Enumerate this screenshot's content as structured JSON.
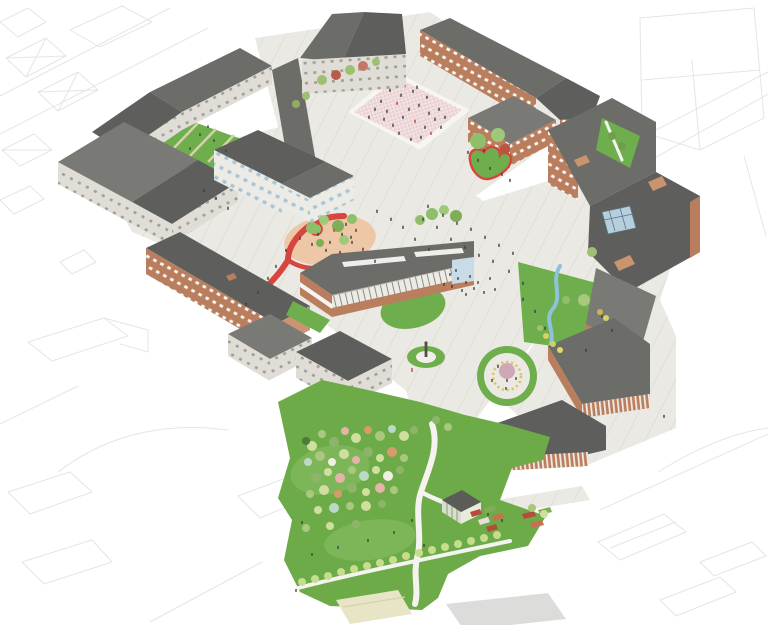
{
  "scene": {
    "kind": "axonometric-masterplan-illustration",
    "subject": "campus masterplan with brick and grey-roofed buildings, paved plazas, lawns, a red ribbon path, a circular pergola garden and a tree-filled park, surrounded by faint line-drawn context city blocks"
  },
  "palette": {
    "white": "#f6f5f1",
    "contextLine": "#e6e5e3",
    "ground": "#ebe9e4",
    "groundLine": "#dcd9d2",
    "roofDark": "#5e5f5c",
    "roofMid": "#6c6d69",
    "roofMid2": "#797a75",
    "roofLight": "#8b8c86",
    "wallLight": "#e0ddd6",
    "wallWhite": "#edebe5",
    "brick": "#b97e5d",
    "brickLight": "#c9946f",
    "windowBlue": "#a9c6d9",
    "glass": "#c8dbe6",
    "skylight": "#b5cfdd",
    "lawn": "#6fae4c",
    "lawnLight": "#8cc167",
    "parkGreen": "#6cab48",
    "pathBeige": "#d8cfae",
    "pinkPlaza": "#f4e3e3",
    "pinkChecker": "#e9d0d2",
    "ovalPink": "#eec7a7",
    "red": "#d6453f",
    "stream": "#8fc2d8",
    "pergolaYellow": "#d8c469",
    "beigeLot": "#e8e4c6",
    "grayLot": "#dcdcda",
    "people": "#3e3e3e",
    "statue": "#564e44",
    "treeTrunk": "#6b5840",
    "greenhouseWall": "#d8decf",
    "greenhouseRoof": "#5b5b58"
  },
  "features": [
    {
      "name": "context-city-outlines",
      "palette": "contextLine"
    },
    {
      "name": "paved-campus-ground",
      "palette": "ground"
    },
    {
      "name": "courtyard-lawn",
      "palette": "lawn"
    },
    {
      "name": "checkered-plaza",
      "palette": "pinkPlaza"
    },
    {
      "name": "red-ribbon-path",
      "palette": "red"
    },
    {
      "name": "oval-playground",
      "palette": "ovalPink"
    },
    {
      "name": "heart-planter",
      "palette": "lawn"
    },
    {
      "name": "stream",
      "palette": "stream"
    },
    {
      "name": "circular-pergola-garden",
      "palette": "pergolaYellow"
    },
    {
      "name": "statue-mound",
      "palette": "lawn"
    },
    {
      "name": "community-park",
      "palette": "parkGreen"
    },
    {
      "name": "greenhouse",
      "palette": "greenhouseWall"
    },
    {
      "name": "allotment-beds",
      "palette": "red"
    }
  ],
  "scatters": [
    {
      "target": "park-trees",
      "name": "park-tree",
      "kind": "circle",
      "color": "#a9c87e",
      "size": 4,
      "points": [
        [
          312,
          446,
          5,
          "#cfe09e"
        ],
        [
          322,
          434,
          4,
          "#a9c87e"
        ],
        [
          334,
          442,
          5,
          "#8db56a"
        ],
        [
          345,
          431,
          4,
          "#e6b3a8"
        ],
        [
          356,
          438,
          5,
          "#cfe09e"
        ],
        [
          368,
          430,
          4,
          "#d79a69"
        ],
        [
          380,
          436,
          5,
          "#a9c87e"
        ],
        [
          392,
          429,
          4,
          "#bcd8c6"
        ],
        [
          404,
          436,
          5,
          "#cfe09e"
        ],
        [
          414,
          430,
          4,
          "#8db56a"
        ],
        [
          306,
          441,
          4,
          "#50793b"
        ],
        [
          308,
          462,
          4,
          "#bcd8c6"
        ],
        [
          320,
          456,
          5,
          "#a9c87e"
        ],
        [
          332,
          462,
          4,
          "#f0efe4"
        ],
        [
          344,
          454,
          5,
          "#cfe09e"
        ],
        [
          356,
          460,
          4,
          "#e6b3a8"
        ],
        [
          368,
          452,
          5,
          "#8db56a"
        ],
        [
          380,
          458,
          4,
          "#cfe09e"
        ],
        [
          392,
          452,
          5,
          "#d79a69"
        ],
        [
          404,
          458,
          4,
          "#a9c87e"
        ],
        [
          316,
          478,
          5,
          "#8db56a"
        ],
        [
          328,
          472,
          4,
          "#cfe09e"
        ],
        [
          340,
          478,
          5,
          "#e6b3a8"
        ],
        [
          352,
          470,
          4,
          "#a9c87e"
        ],
        [
          364,
          476,
          5,
          "#bcd8c6"
        ],
        [
          376,
          470,
          4,
          "#cfe09e"
        ],
        [
          388,
          476,
          5,
          "#f0efe4"
        ],
        [
          400,
          470,
          4,
          "#8db56a"
        ],
        [
          310,
          494,
          4,
          "#a9c87e"
        ],
        [
          324,
          490,
          5,
          "#cfe09e"
        ],
        [
          338,
          494,
          4,
          "#d79a69"
        ],
        [
          352,
          488,
          5,
          "#8db56a"
        ],
        [
          366,
          492,
          4,
          "#cfe09e"
        ],
        [
          380,
          488,
          5,
          "#e6b3a8"
        ],
        [
          394,
          490,
          4,
          "#a9c87e"
        ],
        [
          318,
          510,
          4,
          "#cfe09e"
        ],
        [
          334,
          508,
          5,
          "#bcd8c6"
        ],
        [
          350,
          506,
          4,
          "#a9c87e"
        ],
        [
          366,
          506,
          5,
          "#cfe09e"
        ],
        [
          382,
          504,
          4,
          "#8db56a"
        ],
        [
          306,
          528,
          4,
          "#a9c87e"
        ],
        [
          330,
          526,
          4,
          "#cfe09e"
        ],
        [
          356,
          524,
          4,
          "#8db56a"
        ],
        [
          436,
          420,
          4,
          "#8db56a"
        ],
        [
          448,
          427,
          4,
          "#a9c87e"
        ],
        [
          532,
          508,
          4,
          "#a9c87e"
        ],
        [
          544,
          514,
          4,
          "#cfe09e"
        ]
      ]
    },
    {
      "target": "row-trees",
      "name": "path-row-tree",
      "kind": "circle",
      "color": "#c6dc8e",
      "size": 4,
      "points": [
        [
          302,
          582
        ],
        [
          315,
          579
        ],
        [
          328,
          576
        ],
        [
          341,
          572
        ],
        [
          354,
          569
        ],
        [
          367,
          566
        ],
        [
          380,
          563
        ],
        [
          393,
          560
        ],
        [
          406,
          556
        ],
        [
          419,
          553
        ],
        [
          432,
          550
        ],
        [
          445,
          547
        ],
        [
          458,
          544
        ],
        [
          471,
          541
        ],
        [
          484,
          538
        ],
        [
          497,
          535
        ]
      ]
    },
    {
      "target": "north-row-trees",
      "name": "street-tree",
      "kind": "circle",
      "color": "#9fbf72",
      "size": 4,
      "points": [
        [
          322,
          80,
          5,
          "#9fbf72"
        ],
        [
          336,
          75,
          5,
          "#b85c4a"
        ],
        [
          350,
          70,
          5,
          "#9fbf72"
        ],
        [
          363,
          66,
          5,
          "#c4766a"
        ],
        [
          376,
          62,
          4,
          "#9fbf72"
        ],
        [
          306,
          96,
          4,
          "#9fbf72"
        ],
        [
          296,
          104,
          4,
          "#8fae62"
        ]
      ]
    },
    {
      "target": "oval-trees",
      "name": "playground-tree",
      "kind": "circle",
      "color": "#8fbf6a",
      "size": 5,
      "points": [
        [
          312,
          228,
          6,
          "#8fbf6a"
        ],
        [
          324,
          220,
          5,
          "#9fc978"
        ],
        [
          338,
          226,
          6,
          "#7fae56"
        ],
        [
          352,
          219,
          5,
          "#8fbf6a"
        ],
        [
          344,
          240,
          5,
          "#9fc978"
        ],
        [
          320,
          243,
          4,
          "#7fae56"
        ]
      ]
    },
    {
      "target": "walk-trees",
      "name": "walk-tree",
      "kind": "circle",
      "color": "#8fbf6a",
      "size": 5,
      "points": [
        [
          432,
          214,
          6,
          "#8fbf6a"
        ],
        [
          444,
          210,
          5,
          "#9fc978"
        ],
        [
          456,
          216,
          6,
          "#7fae56"
        ],
        [
          420,
          220,
          5,
          "#8fbf6a"
        ]
      ]
    },
    {
      "target": "heart-trees",
      "name": "heart-planter-tree",
      "kind": "circle",
      "color": "#8fbf6a",
      "size": 6,
      "points": [
        [
          478,
          141,
          8,
          "#8fbf6a"
        ],
        [
          498,
          135,
          7,
          "#9fc978"
        ],
        [
          505,
          149,
          5,
          "#b8543f"
        ]
      ]
    },
    {
      "target": "ne-lawn-trees",
      "name": "lawn-tree",
      "kind": "circle",
      "color": "#6f9e4f",
      "size": 4,
      "points": [
        [
          612,
          136
        ],
        [
          622,
          146
        ]
      ]
    },
    {
      "target": "stream-plants",
      "name": "stream-plant",
      "kind": "circle",
      "color": "#c9d45e",
      "size": 3,
      "points": [
        [
          546,
          336,
          3,
          "#d8d262"
        ],
        [
          553,
          344,
          3,
          "#c9d45e"
        ],
        [
          560,
          350,
          3,
          "#e0d968"
        ],
        [
          540,
          328,
          3,
          "#9fbf72"
        ],
        [
          566,
          300,
          4,
          "#8fbf6a"
        ],
        [
          592,
          252,
          5,
          "#9fbf72"
        ],
        [
          600,
          312,
          3,
          "#c9b84a"
        ],
        [
          606,
          318,
          3,
          "#d8d262"
        ],
        [
          584,
          300,
          6,
          "#a9c87e"
        ]
      ]
    },
    {
      "target": "plaza-people",
      "name": "person",
      "kind": "person",
      "color": "#3e3e3e",
      "size": 3.4,
      "points": [
        [
          390,
          92
        ],
        [
          401,
          97
        ],
        [
          413,
          93
        ],
        [
          397,
          105,
          3.4,
          "#b0473c"
        ],
        [
          409,
          111
        ],
        [
          419,
          107
        ],
        [
          387,
          113
        ],
        [
          429,
          115
        ],
        [
          415,
          123,
          3.4,
          "#b0473c"
        ],
        [
          403,
          119
        ],
        [
          393,
          127
        ],
        [
          425,
          129
        ],
        [
          435,
          121
        ],
        [
          381,
          103
        ],
        [
          375,
          111
        ],
        [
          431,
          135,
          3.4,
          "#b0473c"
        ],
        [
          421,
          139
        ],
        [
          441,
          129
        ],
        [
          411,
          141
        ],
        [
          399,
          135
        ],
        [
          369,
          119
        ],
        [
          445,
          119
        ],
        [
          439,
          111
        ],
        [
          427,
          99
        ],
        [
          417,
          89
        ],
        [
          384,
          121
        ]
      ]
    },
    {
      "target": "north-people",
      "name": "person",
      "kind": "person",
      "color": "#3e3e3e",
      "size": 3.2,
      "points": [
        [
          478,
          162
        ],
        [
          490,
          170
        ],
        [
          502,
          176
        ],
        [
          468,
          154
        ],
        [
          510,
          182
        ],
        [
          484,
          152
        ]
      ]
    },
    {
      "target": "central-people",
      "name": "person",
      "kind": "person",
      "color": "#3e3e3e",
      "size": 3.4,
      "points": [
        [
          428,
          208
        ],
        [
          443,
          217
        ],
        [
          457,
          225
        ],
        [
          471,
          231
        ],
        [
          485,
          239
        ],
        [
          499,
          247
        ],
        [
          513,
          255
        ],
        [
          465,
          249
        ],
        [
          451,
          241
        ],
        [
          437,
          229
        ],
        [
          423,
          221
        ],
        [
          493,
          263
        ],
        [
          479,
          257
        ],
        [
          509,
          273
        ],
        [
          523,
          285
        ],
        [
          429,
          251
        ],
        [
          415,
          241
        ],
        [
          403,
          229
        ],
        [
          391,
          221
        ],
        [
          377,
          213
        ],
        [
          351,
          239
        ],
        [
          363,
          251
        ],
        [
          375,
          263
        ],
        [
          523,
          301
        ],
        [
          535,
          313
        ],
        [
          545,
          330
        ],
        [
          412,
          372,
          4,
          "#c13f38"
        ]
      ]
    },
    {
      "target": "entrance-people",
      "name": "person",
      "kind": "person",
      "color": "#3e3e3e",
      "size": 3,
      "points": [
        [
          450,
          276
        ],
        [
          458,
          280
        ],
        [
          466,
          284
        ],
        [
          452,
          288
        ],
        [
          462,
          292
        ],
        [
          444,
          286
        ],
        [
          470,
          278
        ],
        [
          474,
          290
        ],
        [
          456,
          272
        ],
        [
          466,
          296
        ],
        [
          478,
          284
        ],
        [
          484,
          294
        ],
        [
          490,
          280
        ],
        [
          495,
          291
        ]
      ]
    },
    {
      "target": "ribbon-people",
      "name": "person",
      "kind": "person",
      "color": "#3e3e3e",
      "size": 3.2,
      "points": [
        [
          268,
          280
        ],
        [
          276,
          268
        ],
        [
          258,
          294
        ],
        [
          286,
          252
        ],
        [
          246,
          306
        ],
        [
          300,
          240
        ],
        [
          216,
          200
        ],
        [
          204,
          192
        ],
        [
          228,
          210
        ]
      ]
    },
    {
      "target": "courtyard-people",
      "name": "person",
      "kind": "person",
      "color": "#3e3e3e",
      "size": 2.8,
      "points": [
        [
          200,
          136
        ],
        [
          214,
          142
        ],
        [
          190,
          150
        ],
        [
          226,
          152
        ],
        [
          208,
          128
        ]
      ]
    },
    {
      "target": "park-people",
      "name": "person",
      "kind": "person",
      "color": "#3e3e3e",
      "size": 3,
      "points": [
        [
          312,
          556
        ],
        [
          338,
          549
        ],
        [
          368,
          542
        ],
        [
          394,
          534
        ],
        [
          412,
          522
        ],
        [
          302,
          524
        ],
        [
          424,
          547
        ],
        [
          488,
          516
        ],
        [
          502,
          522
        ],
        [
          296,
          592
        ]
      ]
    },
    {
      "target": "pergola-people",
      "name": "person",
      "kind": "person",
      "color": "#3e3e3e",
      "size": 3,
      "points": [
        [
          498,
          368
        ],
        [
          516,
          380
        ],
        [
          506,
          390
        ],
        [
          492,
          382
        ]
      ]
    },
    {
      "target": "east-people",
      "name": "person",
      "kind": "person",
      "color": "#3e3e3e",
      "size": 3.2,
      "points": [
        [
          602,
          318
        ],
        [
          612,
          332
        ],
        [
          664,
          418
        ],
        [
          586,
          352
        ]
      ]
    },
    {
      "target": "oval-people",
      "name": "person",
      "kind": "person",
      "color": "#3e3e3e",
      "size": 3.2,
      "points": [
        [
          318,
          236
        ],
        [
          330,
          244
        ],
        [
          342,
          236
        ],
        [
          352,
          244
        ],
        [
          326,
          252
        ],
        [
          340,
          254
        ],
        [
          312,
          246
        ],
        [
          356,
          232
        ],
        [
          346,
          226
        ],
        [
          334,
          232,
          3.2,
          "#b0473c"
        ]
      ]
    }
  ]
}
